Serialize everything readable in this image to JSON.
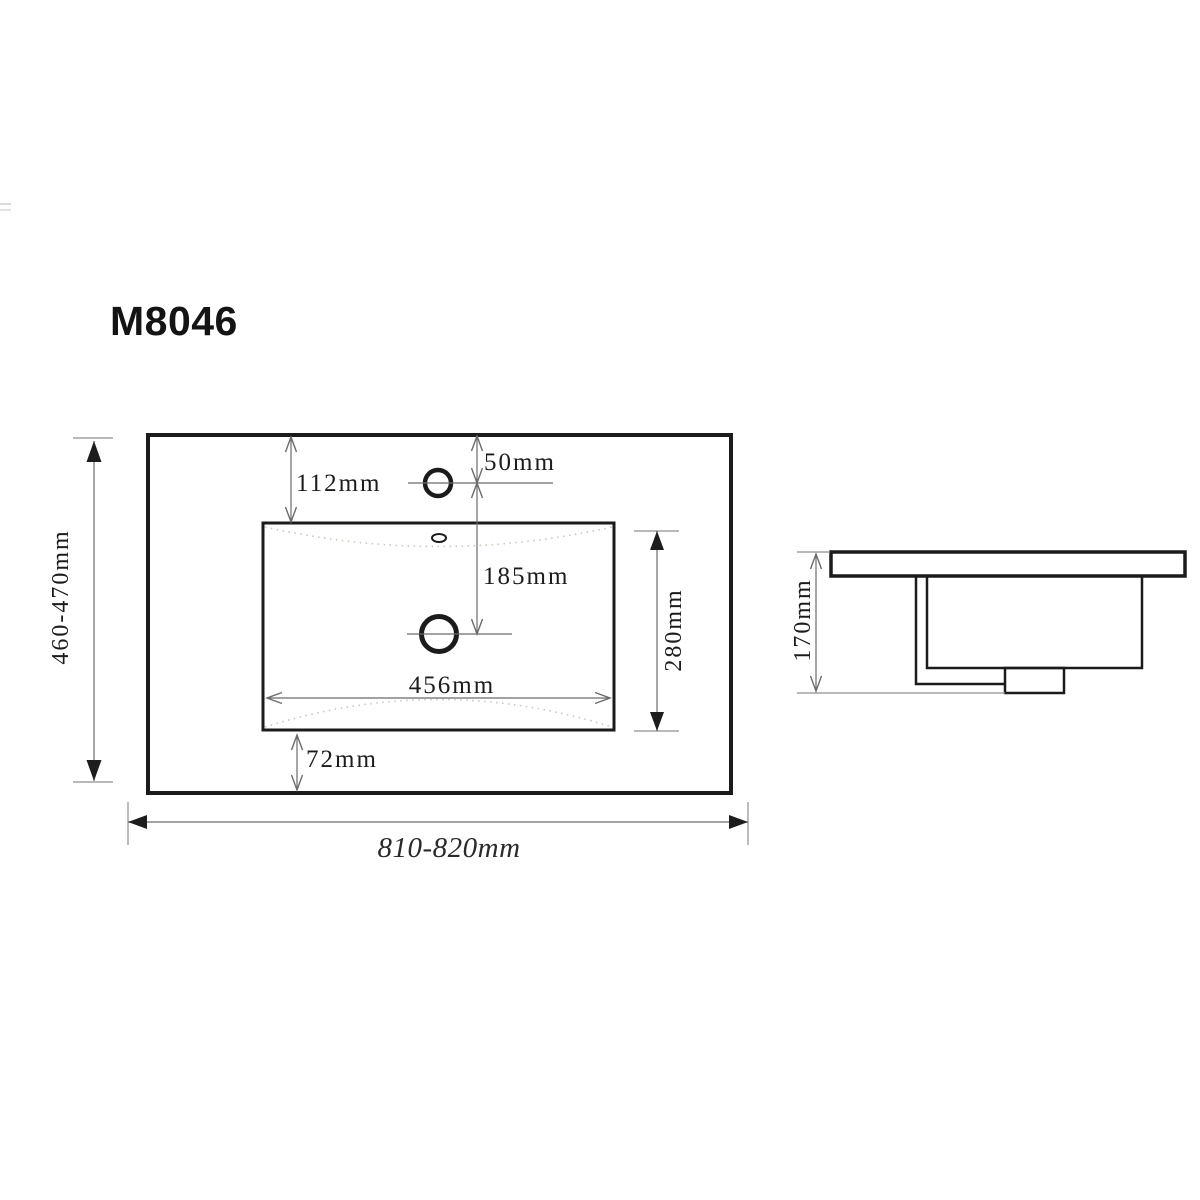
{
  "title": "M8046",
  "colors": {
    "background": "#ffffff",
    "object_line": "#1b1b1b",
    "dimension_line": "#6b6b6b",
    "text": "#1c1c1c",
    "dotted_contour": "#c8c8bc"
  },
  "top_view": {
    "name": "sink top (plan) view",
    "dimensions": {
      "top_edge_to_basin": "112mm",
      "faucet_hole_offset": "50mm",
      "faucet_to_drain": "185mm",
      "basin_width": "456mm",
      "basin_depth": "280mm",
      "basin_to_front_edge": "72mm",
      "overall_width": "810-820mm",
      "overall_depth": "460-470mm"
    }
  },
  "side_view": {
    "name": "sink side profile view",
    "dimensions": {
      "overall_height": "170mm"
    }
  }
}
